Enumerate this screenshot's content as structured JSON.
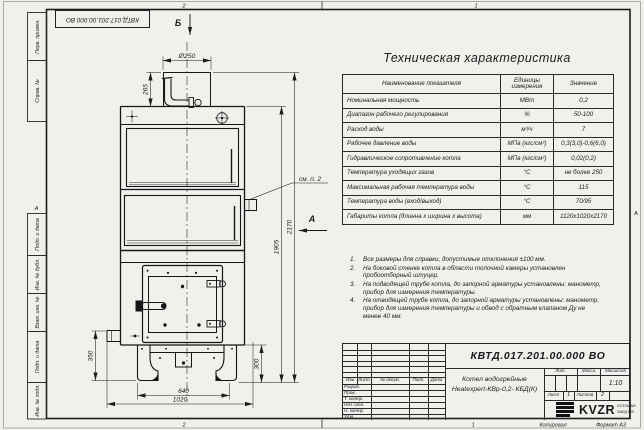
{
  "sheet": {
    "stamp_top": "КВТД.017.201.00.000 ВО",
    "margin_labels": [
      "Перв. примен.",
      "Справ. №",
      "Подп. и дата",
      "Инв. № дубл.",
      "Взам. инв. №",
      "Подп. и дата",
      "Инв. № подл."
    ],
    "zones": {
      "top_left": "2",
      "top_right": "1",
      "bottom_left": "2",
      "bottom_right": "1",
      "side": "А"
    },
    "footer": {
      "copied": "Копировал",
      "format": "Формат А3"
    }
  },
  "drawing": {
    "view_top": "Б",
    "view_side": "А",
    "callout": "см. п. 2",
    "dims": {
      "flue_diameter": "Ø250",
      "flue_height": "265",
      "body_height": "1905",
      "total_height": "2170",
      "left_height": "350",
      "right_height": "300",
      "base_width": "640",
      "total_width": "1020"
    }
  },
  "spec": {
    "title": "Техническая характеристика",
    "headers": [
      "Наименование показателя",
      "Единицы измерения",
      "Значение"
    ],
    "rows": [
      [
        "Номинальная мощность",
        "МВт",
        "0,2"
      ],
      [
        "Диапазон рабочего регулирования",
        "%",
        "50-100"
      ],
      [
        "Расход воды",
        "м³/ч",
        "7"
      ],
      [
        "Рабочее давление воды",
        "МПа (кгс/см²)",
        "0,3(3,0)-0,6(6,0)"
      ],
      [
        "Гидравлическое сопротивление котла",
        "МПа (кгс/см²)",
        "0,02(0,2)"
      ],
      [
        "Температура уходящих газов",
        "°С",
        "не более 250"
      ],
      [
        "Максимальная рабочая температура воды",
        "°С",
        "115"
      ],
      [
        "Температура воды (вход/выход)",
        "°С",
        "70/95"
      ],
      [
        "Габариты котла (длинна х ширина х высота)",
        "мм",
        "1120х1020х2170"
      ]
    ]
  },
  "note_numbers": [
    "1.",
    "2.",
    "3.",
    "4."
  ],
  "notes": [
    "Все размеры для справки, допустимые отклонения ±100 мм.",
    "На боковой стенке котла в области топочной камеры установлен пробоотборный штуцер.",
    "На подводящей трубе котла, до запорной арматуры установлены: манометр, прибор для измерения температуры.",
    "На отводящей трубе котла, до запорной арматуры установлены: манометр, прибор для измерения температуры и обвод с обратным клапаном Ду не менее 40 мм."
  ],
  "title_block": {
    "designation": "КВТД.017.201.00.000 ВО",
    "product_line1": "Котел водогрейные",
    "product_line2": "Heatexpert-КВр-0,2- КБД(К)",
    "rev_cols": [
      "Изм",
      "Лист",
      "№ докум.",
      "Подп.",
      "Дата"
    ],
    "sign_rows": [
      "Разраб.",
      "Пров.",
      "Т. контр.",
      "Нач. отд.",
      "Н. контр.",
      "Утв."
    ],
    "lit": "Лит.",
    "mass": "Масса",
    "scale": "Масштаб",
    "scale_value": "1:10",
    "sheet": "Лист",
    "sheet_no": "1",
    "sheets": "Листов",
    "sheets_no": "2",
    "brand": "KVZR",
    "brand_line1": "КОТЕЛЬНЫЙ",
    "brand_line2": "ЗАВОД РЭП"
  }
}
